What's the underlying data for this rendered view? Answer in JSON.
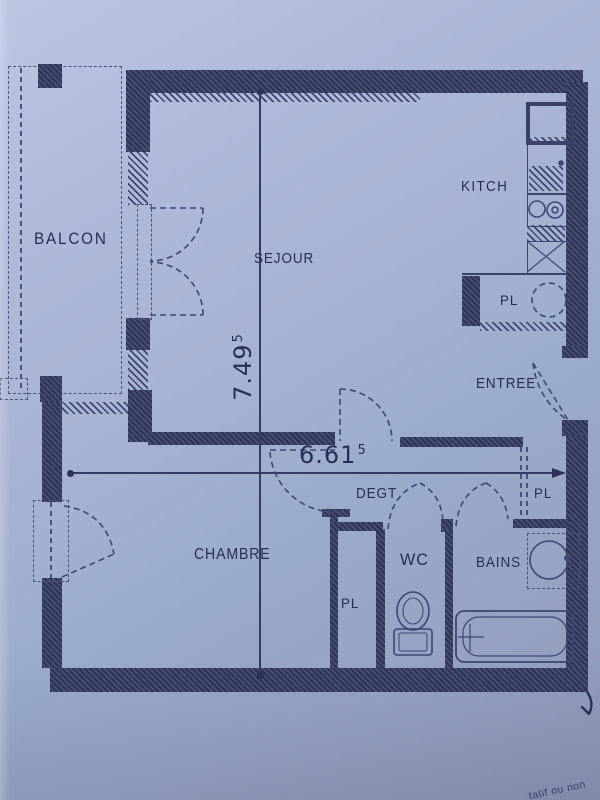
{
  "labels": {
    "balcon": "BALCON",
    "sejour": "SEJOUR",
    "kitchen": "KITCH",
    "entree": "ENTREE",
    "degt": "DEGT",
    "chambre": "CHAMBRE",
    "wc": "WC",
    "bains": "BAINS",
    "pl_kitchen": "PL",
    "pl_entry": "PL",
    "pl_chambre": "PL"
  },
  "dimensions": {
    "vertical": {
      "value": "7.49",
      "sup": "5"
    },
    "horizontal": {
      "value": "6.61",
      "sup": "5"
    }
  },
  "margin_note_fragment": "tatif ou non",
  "symbols": [
    "fridge",
    "sink",
    "stove",
    "hob-cross",
    "water-heater",
    "washbasin",
    "bathtub",
    "toilet",
    "door-swing",
    "window"
  ],
  "colors": {
    "paper": "#a6b2d0",
    "ink": "#2a3154",
    "wall": "#3a4165",
    "dash": "#4a5380"
  }
}
